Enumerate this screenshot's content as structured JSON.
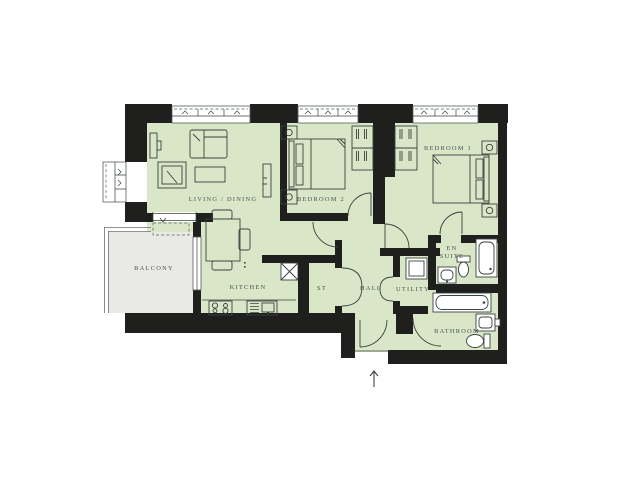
{
  "floorplan": {
    "title": "Two bedroom apartment floor plan",
    "rooms": [
      {
        "id": "living-dining",
        "label": "LIVING / DINING"
      },
      {
        "id": "bedroom-2",
        "label": "BEDROOM 2"
      },
      {
        "id": "bedroom-1",
        "label": "BEDROOM 1"
      },
      {
        "id": "balcony",
        "label": "BALCONY"
      },
      {
        "id": "kitchen",
        "label": "KITCHEN"
      },
      {
        "id": "store",
        "label": "ST"
      },
      {
        "id": "hall",
        "label": "HALL"
      },
      {
        "id": "utility",
        "label": "UTILITY"
      },
      {
        "id": "en-suite",
        "label": "EN SUITE",
        "line1": "EN",
        "line2": "SUITE"
      },
      {
        "id": "bathroom",
        "label": "BATHROOM"
      }
    ],
    "icons": {
      "entrance_arrow": "up-arrow",
      "balcony_door_chevron": "chevron-down"
    },
    "colors": {
      "floor": "#d9e6c8",
      "balcony_floor": "#e9e9e6",
      "wall": "#1f1f1d",
      "furniture_line": "#3a433d",
      "label_text": "#4a554d",
      "background": "#ffffff"
    },
    "furniture": [
      "sofa",
      "armchair",
      "coffee-table",
      "tv-unit",
      "sideboard",
      "dining-table",
      "dining-chairs",
      "kitchen-hob",
      "kitchen-sink",
      "services-cupboard",
      "double-bed",
      "bedside-tables",
      "wardrobes",
      "washing-machine",
      "shower",
      "wc",
      "basin",
      "bath"
    ]
  }
}
